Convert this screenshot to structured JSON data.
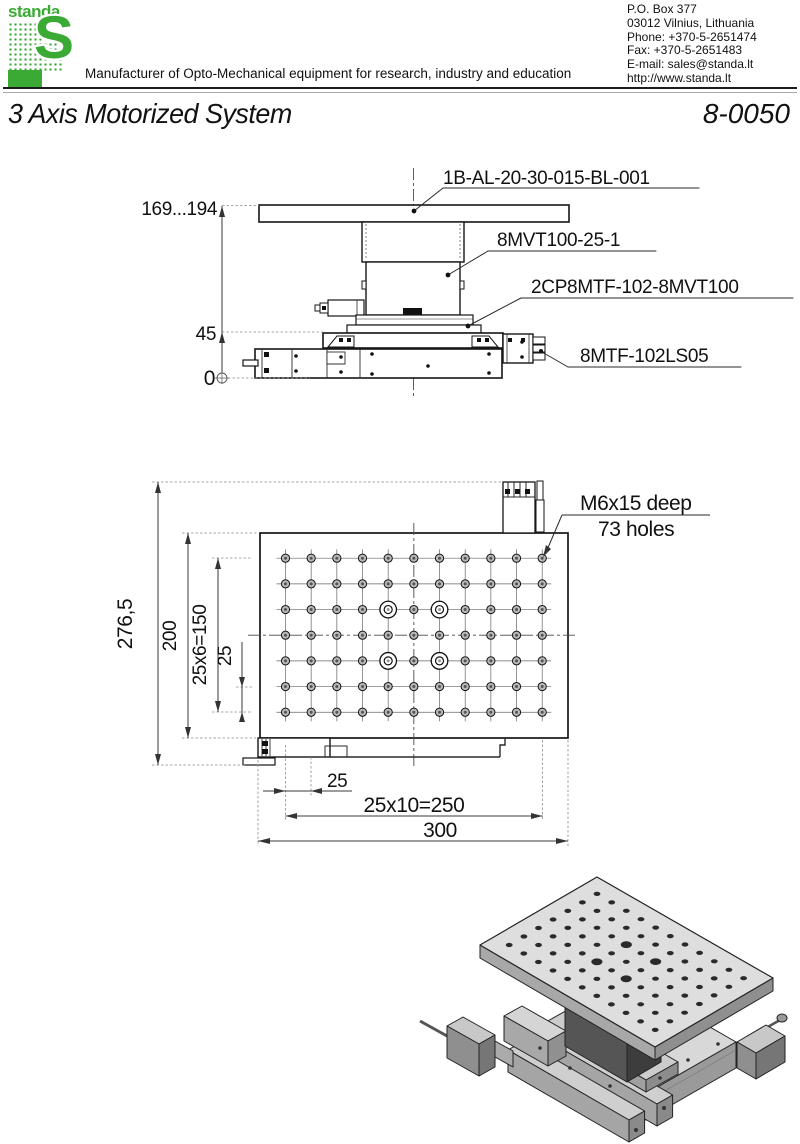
{
  "header": {
    "logo_word": "standa",
    "logo_s": "S",
    "tagline": "Manufacturer of Opto-Mechanical equipment for research, industry and education",
    "contact_lines": [
      "P.O. Box 377",
      "03012 Vilnius, Lithuania",
      "Phone: +370-5-2651474",
      "Fax: +370-5-2651483",
      "E-mail: sales@standa.lt",
      "http://www.standa.lt"
    ],
    "accent_green": "#3aaa35"
  },
  "title_block": {
    "product_title": "3 Axis Motorized System",
    "doc_number": "8-0050"
  },
  "side_view": {
    "part_labels": {
      "breadboard": "1B-AL-20-30-015-BL-001",
      "vertical_stage": "8MVT100-25-1",
      "adapter_plate": "2CP8MTF-102-8MVT100",
      "xy_stage": "8MTF-102LS05"
    },
    "dim_labels": {
      "height_range": "169...194",
      "mid_height": "45",
      "base_level": "0"
    }
  },
  "top_view": {
    "hole_note_line1": "M6x15 deep",
    "hole_note_line2": "73 holes",
    "dim_labels": {
      "overall_depth": "276,5",
      "plate_depth": "200",
      "row_span": "25x6=150",
      "row_pitch": "25",
      "col_pitch": "25",
      "col_span": "25x10=250",
      "plate_width": "300"
    },
    "hole_grid": {
      "cols": 11,
      "rows": 7,
      "x0": 285.5,
      "y0": 558.2,
      "pitch": 25.67,
      "center_col": 5,
      "center_row": 3,
      "counterbores": [
        [
          4,
          2
        ],
        [
          6,
          2
        ],
        [
          4,
          4
        ],
        [
          6,
          4
        ]
      ]
    }
  },
  "isometric": {
    "plate_quad": [
      [
        480,
        945
      ],
      [
        597,
        877
      ],
      [
        773,
        978
      ],
      [
        655,
        1047
      ]
    ],
    "cols": 11,
    "rows": 7,
    "counterbores": [
      [
        4,
        2
      ],
      [
        6,
        2
      ],
      [
        4,
        4
      ],
      [
        6,
        4
      ]
    ]
  }
}
